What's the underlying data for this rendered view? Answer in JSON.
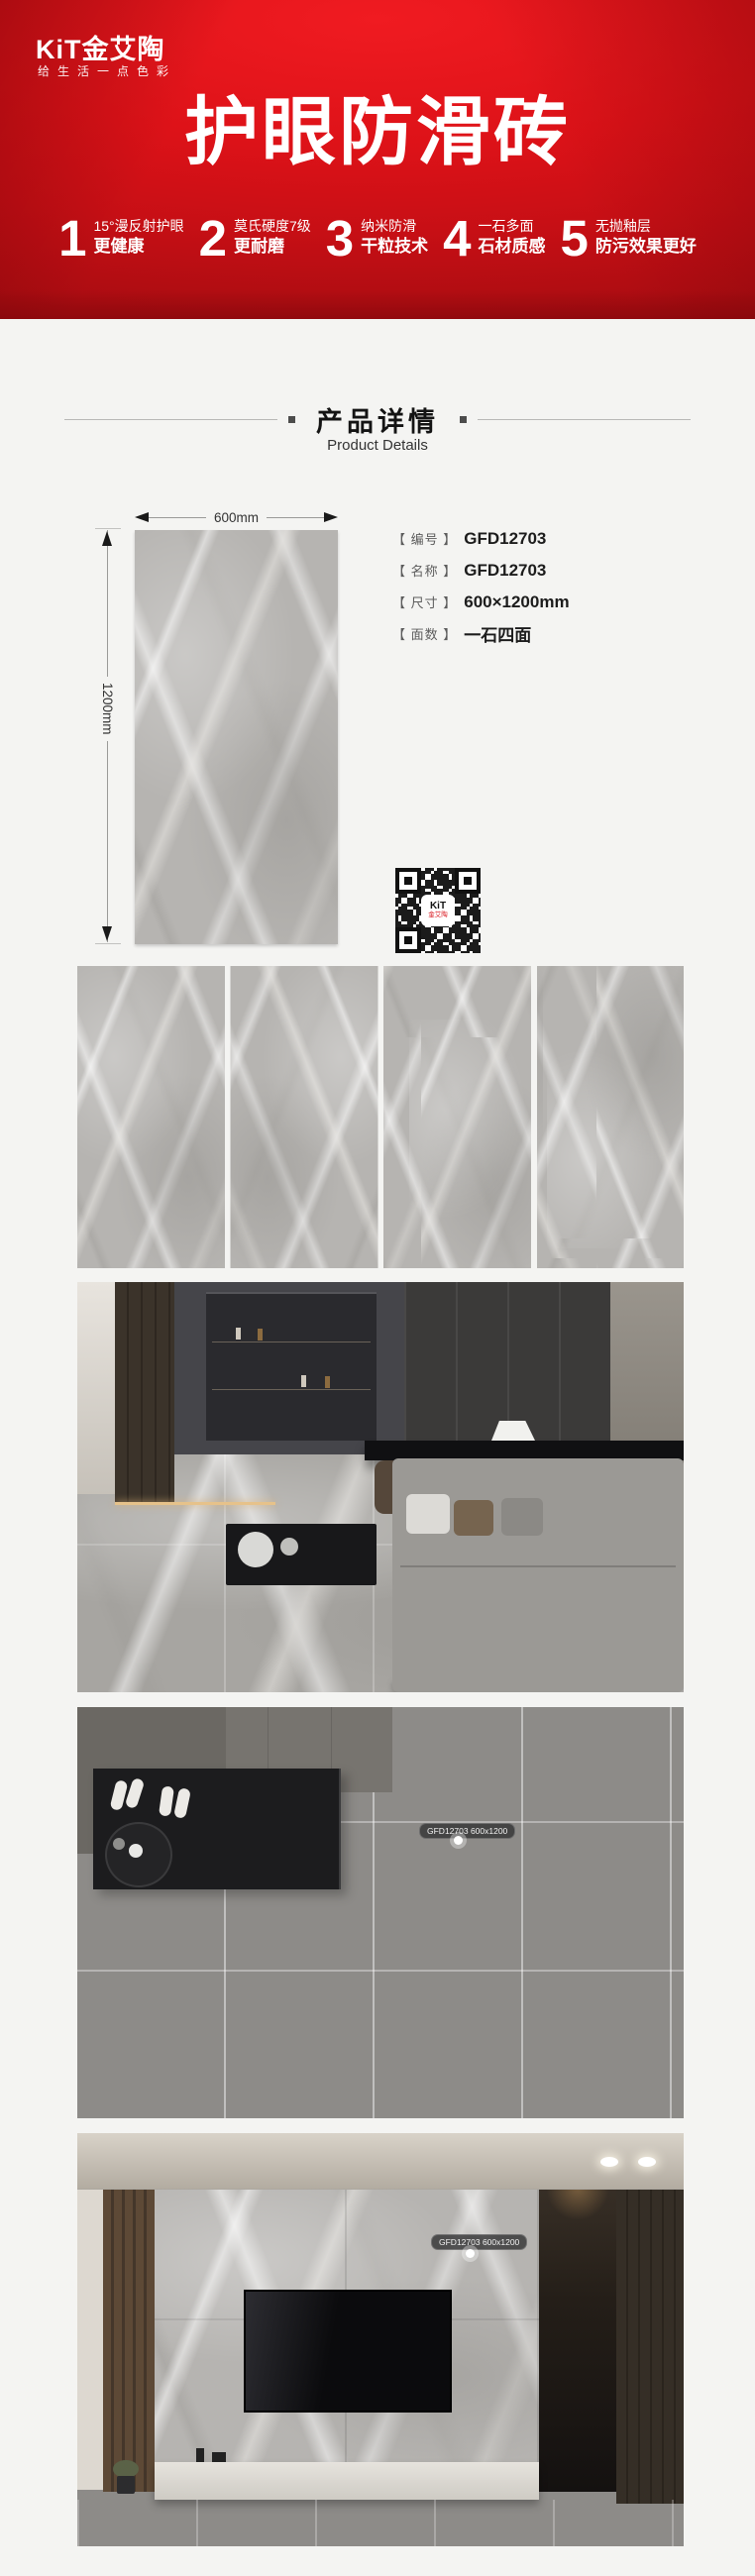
{
  "banner": {
    "logo": "KiT金艾陶",
    "slogan": "给生活一点色彩",
    "title": "护眼防滑砖",
    "features": [
      {
        "num": "1",
        "line1": "15°漫反射护眼",
        "line2": "更健康"
      },
      {
        "num": "2",
        "line1": "莫氏硬度7级",
        "line2": "更耐磨"
      },
      {
        "num": "3",
        "line1": "纳米防滑",
        "line2": "干粒技术"
      },
      {
        "num": "4",
        "line1": "一石多面",
        "line2": "石材质感"
      },
      {
        "num": "5",
        "line1": "无抛釉层",
        "line2": "防污效果更好"
      }
    ]
  },
  "section_header": {
    "title": "产品详情",
    "subtitle": "Product Details"
  },
  "product": {
    "width_label": "600mm",
    "height_label": "1200mm",
    "specs": [
      {
        "label": "【 编号 】",
        "value": "GFD12703"
      },
      {
        "label": "【 名称 】",
        "value": "GFD12703"
      },
      {
        "label": "【 尺寸 】",
        "value": "600×1200mm"
      },
      {
        "label": "【 面数 】",
        "value": "一石四面"
      }
    ],
    "qr": {
      "line1": "KiT",
      "line2": "金艾陶"
    }
  },
  "scenes": {
    "floor_badge": "GFD12703 600x1200",
    "wall_badge": "GFD12703 600x1200"
  },
  "colors": {
    "brand_red": "#d8131b",
    "page_bg": "#f4f4f2",
    "tile_gray": "#b6b4b1"
  }
}
